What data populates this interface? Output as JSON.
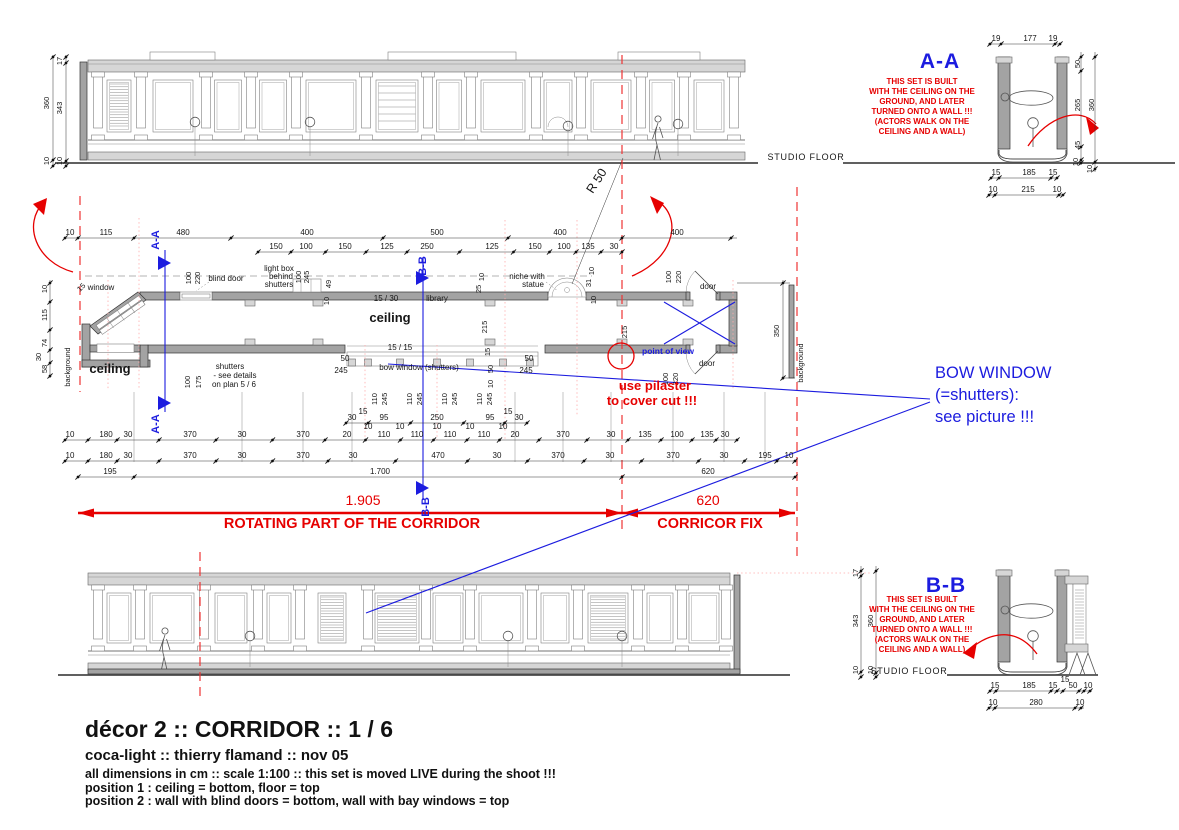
{
  "title_block": {
    "line1": "décor 2 :: CORRIDOR :: 1 / 6",
    "line2": "coca-light :: thierry flamand :: nov 05",
    "line3": "all dimensions in cm :: scale 1:100 :: this set is moved LIVE during the shoot !!!",
    "line4": "position 1 : ceiling = bottom, floor = top",
    "line5": "position 2 : wall with blind doors = bottom, wall with bay windows = top"
  },
  "colors": {
    "red": "#e60000",
    "blue": "#1c1cdf",
    "ink": "#161616",
    "wall": "#a3a3a3"
  },
  "sections": {
    "aa_label": "A-A",
    "bb_label": "B-B",
    "note_lines": [
      "THIS SET IS BUILT",
      "WITH THE CEILING ON THE",
      "GROUND, AND LATER",
      "TURNED ONTO A WALL !!!",
      "(ACTORS WALK ON THE",
      "CEILING AND A WALL)"
    ]
  },
  "red_annotations": {
    "rotating_dim": "1.905",
    "rotating_label": "ROTATING PART OF THE CORRIDOR",
    "fix_dim": "620",
    "fix_label": "CORRICOR FIX",
    "pilaster_note_1": "use pilaster",
    "pilaster_note_2": "to cover cut !!!"
  },
  "blue_annotations": {
    "bow_line1": "BOW WINDOW",
    "bow_line2": "(=shutters):",
    "bow_line3": "see picture !!!",
    "pov": "point of view",
    "cut_aa": "A-A",
    "cut_bb": "B-B"
  },
  "floor_labels": {
    "top": "STUDIO FLOOR",
    "bottom": "STUDIO FLOOR"
  },
  "plan_labels": [
    {
      "t": "blind door",
      "x": 226,
      "y": 281
    },
    {
      "t": "light box",
      "x": 279,
      "y": 271
    },
    {
      "t": "behind",
      "x": 281,
      "y": 279
    },
    {
      "t": "shutters",
      "x": 279,
      "y": 287
    },
    {
      "t": "niche with",
      "x": 527,
      "y": 279
    },
    {
      "t": "statue",
      "x": 533,
      "y": 287
    },
    {
      "t": "15 / 30",
      "x": 386,
      "y": 301
    },
    {
      "t": "library",
      "x": 437,
      "y": 301
    },
    {
      "t": "ceiling",
      "x": 390,
      "y": 322,
      "s": 13,
      "b": 1
    },
    {
      "t": "ceiling",
      "x": 110,
      "y": 373,
      "s": 13,
      "b": 1
    },
    {
      "t": "15 / 15",
      "x": 400,
      "y": 350
    },
    {
      "t": "bow window (shutters)",
      "x": 419,
      "y": 370
    },
    {
      "t": "shutters",
      "x": 230,
      "y": 369
    },
    {
      "t": "- see details",
      "x": 235,
      "y": 378
    },
    {
      "t": "on plan 5 / 6",
      "x": 234,
      "y": 387
    },
    {
      "t": "window",
      "x": 101,
      "y": 290
    },
    {
      "t": "door",
      "x": 708,
      "y": 289
    },
    {
      "t": "door",
      "x": 707,
      "y": 366
    },
    {
      "t": "50",
      "x": 345,
      "y": 361
    },
    {
      "t": "245",
      "x": 341,
      "y": 373
    },
    {
      "t": "50",
      "x": 529,
      "y": 361
    },
    {
      "t": "245",
      "x": 526,
      "y": 373
    },
    {
      "t": "R 50",
      "x": 600,
      "y": 183,
      "s": 12.5,
      "r": -57
    }
  ],
  "rot_dims": [
    {
      "t": "10",
      "x": 47,
      "y": 289
    },
    {
      "t": "115",
      "x": 47,
      "y": 315
    },
    {
      "t": "74",
      "x": 47,
      "y": 343
    },
    {
      "t": "30",
      "x": 41,
      "y": 357
    },
    {
      "t": "58",
      "x": 47,
      "y": 369
    },
    {
      "t": "360",
      "x": 49,
      "y": 103
    },
    {
      "t": "17",
      "x": 62,
      "y": 61
    },
    {
      "t": "343",
      "x": 62,
      "y": 108
    },
    {
      "t": "10",
      "x": 49,
      "y": 161
    },
    {
      "t": "10",
      "x": 62,
      "y": 161
    },
    {
      "t": "100",
      "x": 191,
      "y": 278
    },
    {
      "t": "220",
      "x": 200,
      "y": 278
    },
    {
      "t": "100",
      "x": 301,
      "y": 277
    },
    {
      "t": "245",
      "x": 309,
      "y": 277
    },
    {
      "t": "49",
      "x": 331,
      "y": 284
    },
    {
      "t": "10",
      "x": 329,
      "y": 301
    },
    {
      "t": "10",
      "x": 484,
      "y": 277
    },
    {
      "t": "25",
      "x": 481,
      "y": 289
    },
    {
      "t": "10",
      "x": 594,
      "y": 271
    },
    {
      "t": "31",
      "x": 591,
      "y": 283
    },
    {
      "t": "10",
      "x": 596,
      "y": 300
    },
    {
      "t": "100",
      "x": 671,
      "y": 277
    },
    {
      "t": "220",
      "x": 681,
      "y": 277
    },
    {
      "t": "100",
      "x": 668,
      "y": 379
    },
    {
      "t": "220",
      "x": 678,
      "y": 379
    },
    {
      "t": "215",
      "x": 487,
      "y": 327
    },
    {
      "t": "215",
      "x": 627,
      "y": 332
    },
    {
      "t": "100",
      "x": 190,
      "y": 382
    },
    {
      "t": "175",
      "x": 201,
      "y": 382
    },
    {
      "t": "15",
      "x": 490,
      "y": 352
    },
    {
      "t": "50",
      "x": 493,
      "y": 369
    },
    {
      "t": "10",
      "x": 493,
      "y": 384
    },
    {
      "t": "110",
      "x": 377,
      "y": 399
    },
    {
      "t": "245",
      "x": 387,
      "y": 399
    },
    {
      "t": "110",
      "x": 412,
      "y": 399
    },
    {
      "t": "245",
      "x": 422,
      "y": 399
    },
    {
      "t": "110",
      "x": 447,
      "y": 399
    },
    {
      "t": "245",
      "x": 457,
      "y": 399
    },
    {
      "t": "110",
      "x": 482,
      "y": 399
    },
    {
      "t": "245",
      "x": 492,
      "y": 399
    },
    {
      "t": "350",
      "x": 779,
      "y": 331
    },
    {
      "t": "background",
      "x": 70,
      "y": 367
    },
    {
      "t": "background",
      "x": 803,
      "y": 363
    },
    {
      "t": "15",
      "x": 83,
      "y": 289,
      "r": -45
    },
    {
      "t": "17",
      "x": 858,
      "y": 573
    },
    {
      "t": "343",
      "x": 858,
      "y": 621
    },
    {
      "t": "360",
      "x": 873,
      "y": 621
    },
    {
      "t": "10",
      "x": 858,
      "y": 670
    },
    {
      "t": "10",
      "x": 873,
      "y": 670
    },
    {
      "t": "50",
      "x": 1080,
      "y": 64
    },
    {
      "t": "265",
      "x": 1080,
      "y": 105
    },
    {
      "t": "360",
      "x": 1094,
      "y": 105
    },
    {
      "t": "45",
      "x": 1080,
      "y": 145
    },
    {
      "t": "10",
      "x": 1078,
      "y": 162
    },
    {
      "t": "10",
      "x": 1092,
      "y": 169
    }
  ],
  "free_dims": [
    {
      "t": "10",
      "x": 368,
      "y": 429
    },
    {
      "t": "10",
      "x": 400,
      "y": 429
    },
    {
      "t": "10",
      "x": 437,
      "y": 429
    },
    {
      "t": "10",
      "x": 470,
      "y": 429
    },
    {
      "t": "10",
      "x": 503,
      "y": 429
    },
    {
      "t": "15",
      "x": 363,
      "y": 414
    },
    {
      "t": "15",
      "x": 508,
      "y": 414
    },
    {
      "t": "15",
      "x": 1065,
      "y": 682
    }
  ],
  "dim_rows": [
    {
      "y": 238,
      "x1": 65,
      "x2": 737,
      "dots": [
        65,
        78,
        134,
        231,
        383,
        508,
        622,
        731
      ],
      "labels": [
        {
          "t": "10",
          "x": 70
        },
        {
          "t": "115",
          "x": 106
        },
        {
          "t": "480",
          "x": 183
        },
        {
          "t": "400",
          "x": 307
        },
        {
          "t": "500",
          "x": 437
        },
        {
          "t": "400",
          "x": 560
        },
        {
          "t": "400",
          "x": 677
        }
      ]
    },
    {
      "y": 252,
      "x1": 258,
      "x2": 622,
      "labels": [
        {
          "t": "150",
          "x": 276
        },
        {
          "t": "100",
          "x": 306
        },
        {
          "t": "150",
          "x": 345
        },
        {
          "t": "125",
          "x": 387
        },
        {
          "t": "250",
          "x": 427
        },
        {
          "t": "125",
          "x": 492
        },
        {
          "t": "150",
          "x": 535
        },
        {
          "t": "100",
          "x": 564
        },
        {
          "t": "135",
          "x": 588
        },
        {
          "t": "30",
          "x": 614
        }
      ]
    },
    {
      "y": 423,
      "x1": 346,
      "x2": 527,
      "labels": [
        {
          "t": "30",
          "x": 352
        },
        {
          "t": "95",
          "x": 384
        },
        {
          "t": "250",
          "x": 437
        },
        {
          "t": "95",
          "x": 490
        },
        {
          "t": "30",
          "x": 519
        }
      ]
    },
    {
      "y": 440,
      "x1": 65,
      "x2": 737,
      "labels": [
        {
          "t": "10",
          "x": 70
        },
        {
          "t": "180",
          "x": 106
        },
        {
          "t": "30",
          "x": 128
        },
        {
          "t": "370",
          "x": 190
        },
        {
          "t": "30",
          "x": 242
        },
        {
          "t": "370",
          "x": 303
        },
        {
          "t": "20",
          "x": 347
        },
        {
          "t": "110",
          "x": 384
        },
        {
          "t": "110",
          "x": 417
        },
        {
          "t": "110",
          "x": 450
        },
        {
          "t": "110",
          "x": 484
        },
        {
          "t": "20",
          "x": 515
        },
        {
          "t": "370",
          "x": 563
        },
        {
          "t": "30",
          "x": 611
        },
        {
          "t": "135",
          "x": 645
        },
        {
          "t": "100",
          "x": 677
        },
        {
          "t": "135",
          "x": 707
        },
        {
          "t": "30",
          "x": 725
        }
      ]
    },
    {
      "y": 461,
      "x1": 65,
      "x2": 795,
      "labels": [
        {
          "t": "10",
          "x": 70
        },
        {
          "t": "180",
          "x": 106
        },
        {
          "t": "30",
          "x": 128
        },
        {
          "t": "370",
          "x": 190
        },
        {
          "t": "30",
          "x": 242
        },
        {
          "t": "370",
          "x": 303
        },
        {
          "t": "30",
          "x": 353
        },
        {
          "t": "470",
          "x": 438
        },
        {
          "t": "30",
          "x": 497
        },
        {
          "t": "370",
          "x": 558
        },
        {
          "t": "30",
          "x": 610
        },
        {
          "t": "370",
          "x": 673
        },
        {
          "t": "30",
          "x": 724
        },
        {
          "t": "195",
          "x": 765
        },
        {
          "t": "10",
          "x": 789
        }
      ]
    },
    {
      "y": 477,
      "x1": 78,
      "x2": 795,
      "dots": [
        78,
        134,
        622,
        795
      ],
      "labels": [
        {
          "t": "195",
          "x": 110
        },
        {
          "t": "1.700",
          "x": 380
        },
        {
          "t": "620",
          "x": 708
        }
      ]
    },
    {
      "y": 44,
      "x1": 988,
      "x2": 1061,
      "dots": [
        990,
        1001,
        1055,
        1060
      ],
      "labels": [
        {
          "t": "19",
          "x": 996
        },
        {
          "t": "177",
          "x": 1030
        },
        {
          "t": "19",
          "x": 1053
        }
      ]
    },
    {
      "y": 178,
      "x1": 990,
      "x2": 1058,
      "dots": [
        991,
        999,
        1051,
        1057
      ],
      "labels": [
        {
          "t": "15",
          "x": 996
        },
        {
          "t": "185",
          "x": 1029
        },
        {
          "t": "15",
          "x": 1053
        }
      ]
    },
    {
      "y": 195,
      "x1": 988,
      "x2": 1064,
      "dots": [
        989,
        995,
        1059,
        1063
      ],
      "labels": [
        {
          "t": "10",
          "x": 993
        },
        {
          "t": "215",
          "x": 1028
        },
        {
          "t": "10",
          "x": 1057
        }
      ]
    },
    {
      "y": 691,
      "x1": 990,
      "x2": 1092,
      "dots": [
        990,
        996,
        1051,
        1057,
        1063,
        1079,
        1084,
        1090
      ],
      "labels": [
        {
          "t": "15",
          "x": 995
        },
        {
          "t": "185",
          "x": 1029
        },
        {
          "t": "15",
          "x": 1053
        },
        {
          "t": "50",
          "x": 1073
        },
        {
          "t": "10",
          "x": 1088
        }
      ]
    },
    {
      "y": 708,
      "x1": 988,
      "x2": 1084,
      "dots": [
        989,
        995,
        1075,
        1081
      ],
      "labels": [
        {
          "t": "10",
          "x": 993
        },
        {
          "t": "280",
          "x": 1036
        },
        {
          "t": "10",
          "x": 1080
        }
      ]
    }
  ],
  "vdim_lines": [
    {
      "x": 53,
      "y1": 55,
      "y2": 166,
      "dots": [
        57,
        160,
        166
      ]
    },
    {
      "x": 66,
      "y1": 55,
      "y2": 166,
      "dots": [
        57,
        63,
        161,
        166
      ]
    },
    {
      "x": 50,
      "y1": 280,
      "y2": 378,
      "dots": [
        283,
        302,
        330,
        350,
        363,
        376
      ]
    },
    {
      "x": 783,
      "y1": 280,
      "y2": 380,
      "dots": [
        283,
        378
      ]
    },
    {
      "x": 861,
      "y1": 566,
      "y2": 678,
      "dots": [
        571,
        576,
        672,
        677
      ]
    },
    {
      "x": 876,
      "y1": 566,
      "y2": 678,
      "dots": [
        571,
        673,
        677
      ]
    },
    {
      "x": 1081,
      "y1": 52,
      "y2": 165,
      "dots": [
        57,
        71,
        147,
        160,
        163
      ]
    },
    {
      "x": 1095,
      "y1": 52,
      "y2": 172,
      "dots": [
        57,
        162,
        169
      ]
    }
  ]
}
